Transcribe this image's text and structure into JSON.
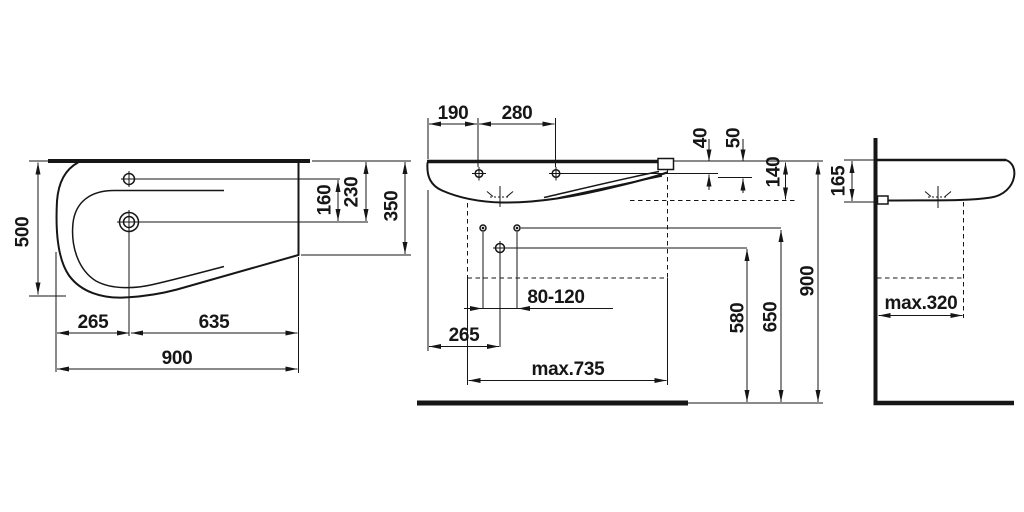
{
  "drawing": {
    "kind": "washbasin-dimension-drawing",
    "line_color": "#161616",
    "background": "#ffffff",
    "plan": {
      "depth": "500",
      "tap_drain": "160",
      "rim_drain": "230",
      "rim_corner": "350",
      "left_drain": "265",
      "drain_right": "635",
      "width": "900"
    },
    "front": {
      "edge_hole": "190",
      "holes": "280",
      "rim_tap": "40",
      "rim_lip": "50",
      "rim_bowl": "140",
      "anchors": "80-120",
      "edge_trap": "265",
      "trap_floor": "580",
      "anchor_floor": "650",
      "rim_floor": "900",
      "max_width": "max.735"
    },
    "side": {
      "rim_under": "165",
      "max_depth": "max.320"
    }
  }
}
